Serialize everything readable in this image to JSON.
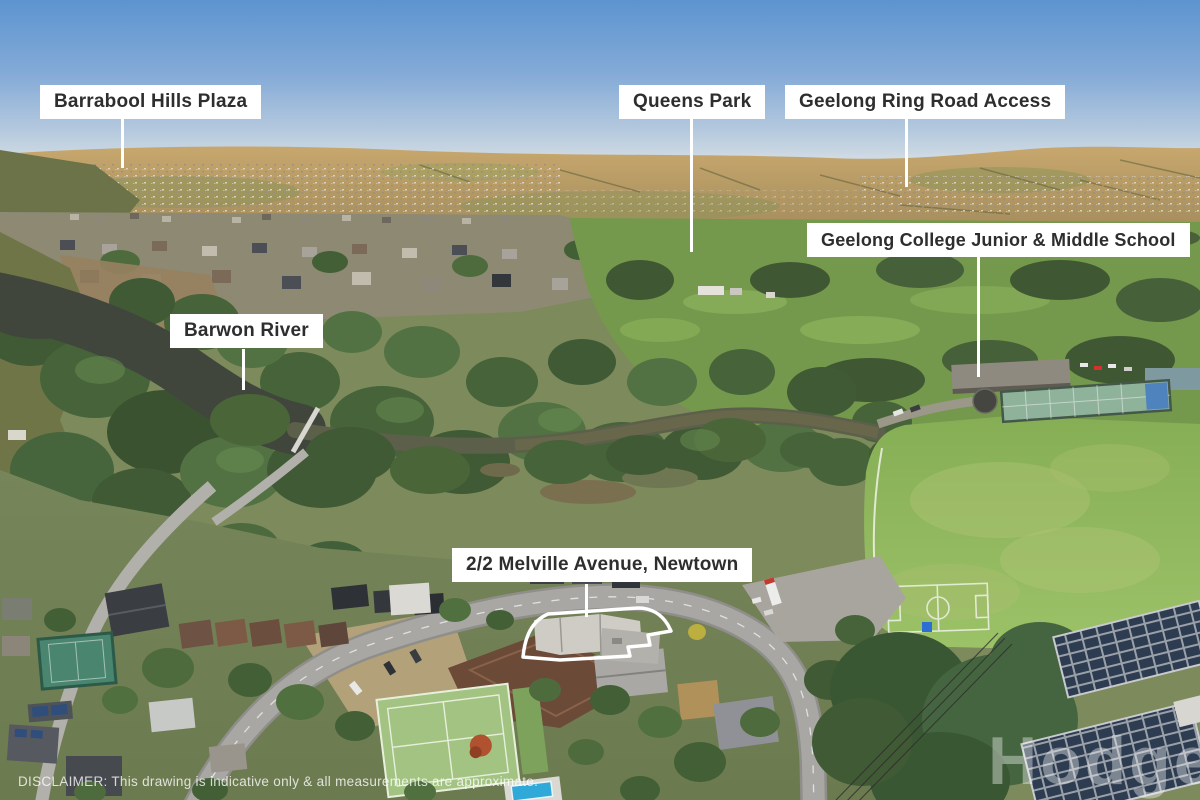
{
  "photo_subject": "aerial drone view over Newtown (Geelong): Barwon River gorge, Queens Park golf course, suburbs, school sports field",
  "labels": [
    {
      "text": "Barrabool Hills Plaza"
    },
    {
      "text": "Queens Park"
    },
    {
      "text": "Geelong Ring Road Access"
    },
    {
      "text": "Geelong College Junior & Middle School"
    },
    {
      "text": "Barwon River"
    },
    {
      "text": "2/2 Melville Avenue, Newtown"
    }
  ],
  "disclaimer": "DISCLAIMER: This drawing is indicative only & all measurements are approximate.",
  "watermark": "Hodges",
  "colors": {
    "label_background": "#ffffff",
    "label_text": "#2e2e2e",
    "leader_line": "#ffffff",
    "property_outline": "#ffffff",
    "sky": "#5d94d0",
    "distant_hills": "#b89a66",
    "trees": "#46633a",
    "river": "#41463d",
    "sports_field": "#8fb95e",
    "road": "#a8a7a3",
    "pool": "#2fa9d8"
  }
}
